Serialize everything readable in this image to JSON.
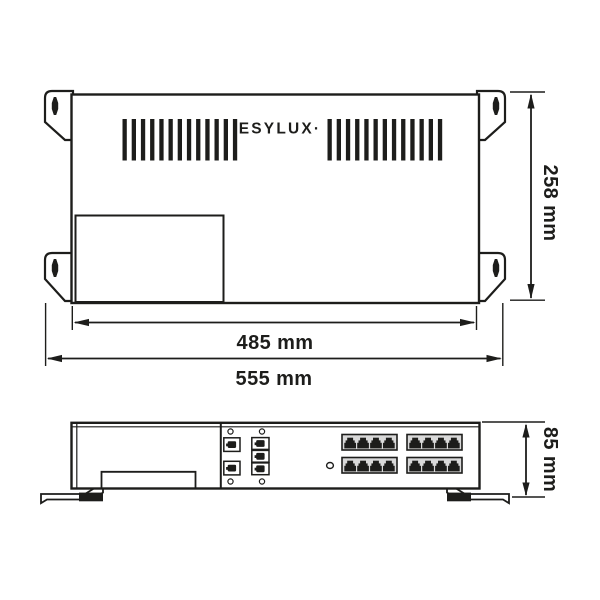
{
  "drawing": {
    "brand_logo": "ESYLUX·",
    "views": {
      "top": "top-view",
      "front": "front-view"
    }
  },
  "dimensions": {
    "inner_width": "485 mm",
    "outer_width": "555 mm",
    "height": "258 mm",
    "depth": "85 mm"
  },
  "features": {
    "vent_slot_groups": 2,
    "vent_slots_per_group": 13,
    "mounting_brackets": 4,
    "keyhole_slots": 4,
    "rj45_banks": 4,
    "rj45_ports_per_bank": 4,
    "small_ports_left_column": 2,
    "small_ports_right_column": 3,
    "screw_holes": 4,
    "led_indicators": 1,
    "feet": 2
  },
  "colors": {
    "line": "#1d1d1b",
    "background": "#ffffff",
    "bank_fill": "#d9d9d9"
  }
}
